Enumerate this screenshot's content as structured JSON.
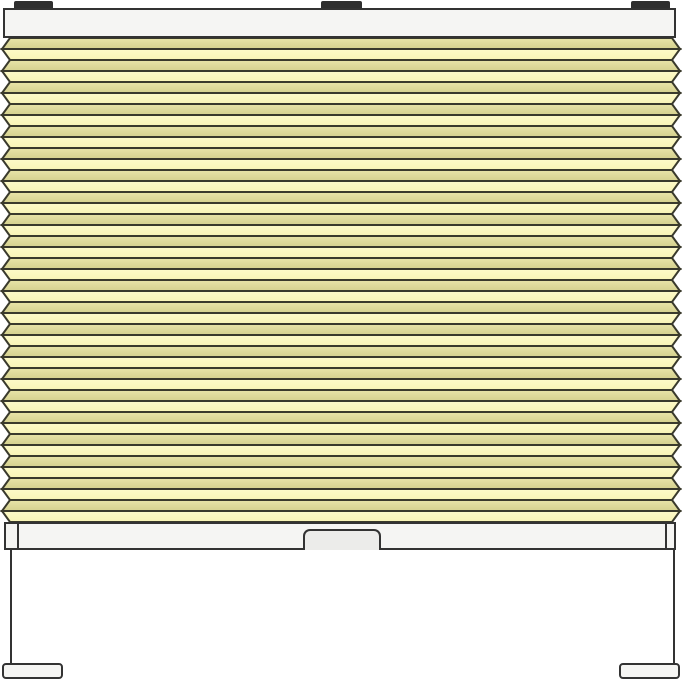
{
  "illustration": {
    "subject": "pleated-blind-front-view",
    "colors": {
      "background": "#ffffff",
      "outline": "#333333",
      "fold_line": "#3a3a2c",
      "rail_fill": "#f5f5f3",
      "handle_fill": "#ececea",
      "top_bracket_fill": "#2f2f2f",
      "foot_bracket_fill": "#f5f5f3",
      "pleat_dark_top": "#e8e4a8",
      "pleat_dark_bottom": "#d5d18e",
      "pleat_light_top": "#fdfac8",
      "pleat_light_bottom": "#f8f4b6"
    },
    "pleats": {
      "face_count": 44,
      "pleat_count": 22,
      "face_height": 11,
      "body_left": 10,
      "body_right": 672,
      "point_left": 2,
      "point_right": 680,
      "first_face_shade": "dark"
    },
    "parts": {
      "top_brackets": 3,
      "headrail": 1,
      "bottom_rail": 1,
      "handle": 1,
      "tension_cords": 2,
      "foot_brackets": 2
    }
  }
}
